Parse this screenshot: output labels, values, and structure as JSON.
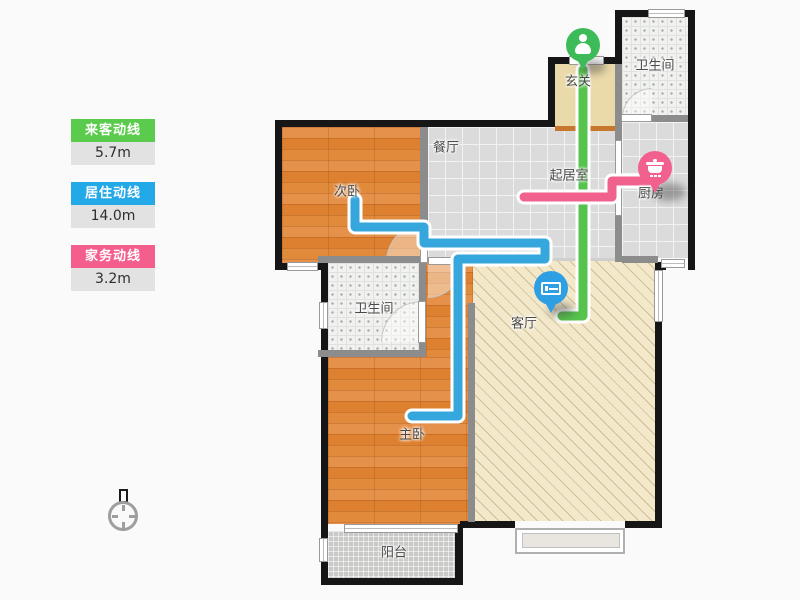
{
  "legend": {
    "items": [
      {
        "label": "来客动线",
        "length": "5.7m",
        "color": "#5bcb4d"
      },
      {
        "label": "居住动线",
        "length": "14.0m",
        "color": "#23a8e8"
      },
      {
        "label": "家务动线",
        "length": "3.2m",
        "color": "#f45e8c"
      }
    ]
  },
  "plan": {
    "rooms": [
      {
        "name": "玄关"
      },
      {
        "name": "卫生间"
      },
      {
        "name": "餐厅"
      },
      {
        "name": "起居室"
      },
      {
        "name": "厨房"
      },
      {
        "name": "次卧"
      },
      {
        "name": "卫生间"
      },
      {
        "name": "客厅"
      },
      {
        "name": "主卧"
      },
      {
        "name": "阳台"
      }
    ],
    "markers": [
      {
        "icon": "person-icon",
        "meaning": "entrance-start",
        "color": "#3cbb58"
      },
      {
        "icon": "pot-icon",
        "meaning": "kitchen-end",
        "color": "#f2608e"
      },
      {
        "icon": "bed-icon",
        "meaning": "living-route",
        "color": "#2e9fe3"
      }
    ],
    "lines": [
      {
        "name": "来客动线",
        "length": "5.7m",
        "color": "#55c34c",
        "points": [
          [
            583,
            70
          ],
          [
            583,
            316
          ],
          [
            562,
            316
          ]
        ]
      },
      {
        "name": "家务动线",
        "length": "3.2m",
        "color": "#f0618e",
        "points": [
          [
            524,
            197
          ],
          [
            612,
            197
          ],
          [
            612,
            181
          ],
          [
            648,
            181
          ]
        ]
      },
      {
        "name": "居住动线",
        "length": "14.0m",
        "color": "#36a7dc",
        "points": [
          [
            355,
            200
          ],
          [
            355,
            227
          ],
          [
            424,
            227
          ],
          [
            424,
            243
          ],
          [
            545,
            243
          ],
          [
            545,
            259
          ],
          [
            458,
            259
          ],
          [
            458,
            416
          ],
          [
            412,
            416
          ]
        ]
      }
    ]
  }
}
